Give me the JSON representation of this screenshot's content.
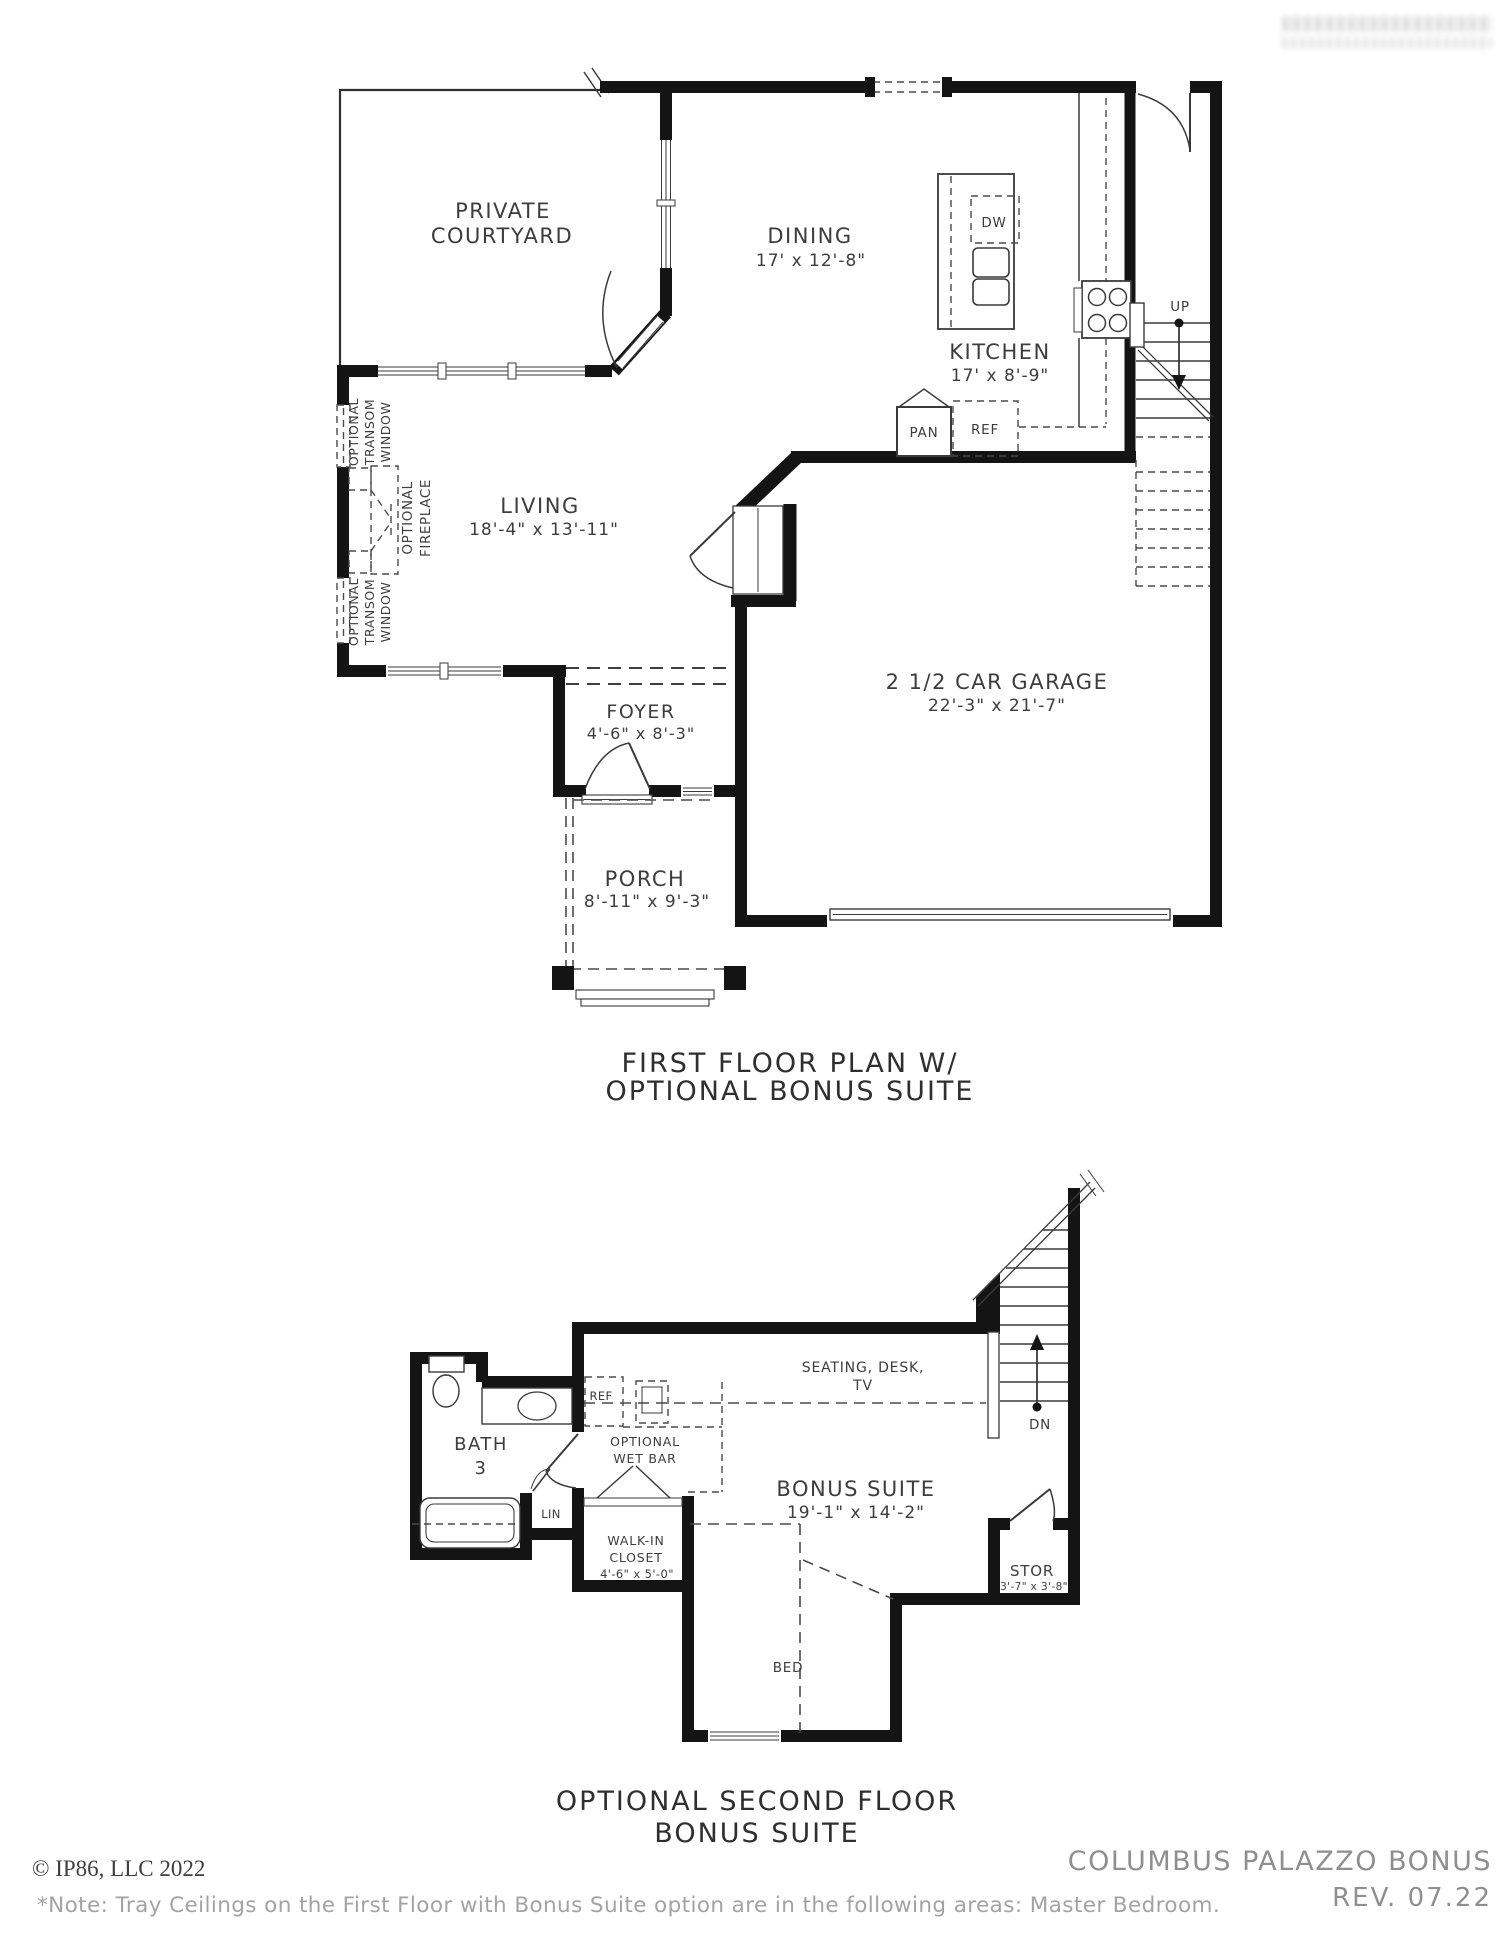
{
  "floor1": {
    "caption_line1": "FIRST FLOOR PLAN W/",
    "caption_line2": "OPTIONAL BONUS SUITE",
    "rooms": {
      "courtyard": {
        "name1": "PRIVATE",
        "name2": "COURTYARD"
      },
      "dining": {
        "name": "DINING",
        "dims": "17' x 12'-8\""
      },
      "kitchen": {
        "name": "KITCHEN",
        "dims": "17' x 8'-9\""
      },
      "living": {
        "name": "LIVING",
        "dims": "18'-4\" x 13'-11\""
      },
      "garage": {
        "name": "2 1/2 CAR GARAGE",
        "dims": "22'-3\" x 21'-7\""
      },
      "foyer": {
        "name": "FOYER",
        "dims": "4'-6\" x 8'-3\""
      },
      "porch": {
        "name": "PORCH",
        "dims": "8'-11\" x 9'-3\""
      }
    },
    "fixtures": {
      "dw": "DW",
      "pan": "PAN",
      "ref": "REF",
      "up": "UP"
    },
    "annotations": {
      "transom_top": [
        "OPTIONAL",
        "TRANSOM",
        "WINDOW"
      ],
      "transom_bottom": [
        "OPTIONAL",
        "TRANSOM",
        "WINDOW"
      ],
      "fireplace": [
        "OPTIONAL",
        "FIREPLACE"
      ]
    }
  },
  "floor2": {
    "caption_line1": "OPTIONAL SECOND FLOOR",
    "caption_line2": "BONUS SUITE",
    "rooms": {
      "bath": {
        "name": "BATH",
        "num": "3"
      },
      "bonus": {
        "name": "BONUS SUITE",
        "dims": "19'-1\" x 14'-2\""
      },
      "closet": {
        "name1": "WALK-IN",
        "name2": "CLOSET",
        "dims": "4'-6\" x 5'-0\""
      },
      "stor": {
        "name": "STOR",
        "dims": "3'-7\" x 3'-8\""
      },
      "wetbar": {
        "name1": "OPTIONAL",
        "name2": "WET BAR"
      },
      "seating": {
        "line1": "SEATING, DESK,",
        "line2": "TV"
      },
      "bed": "BED",
      "lin": "LIN",
      "ref": "REF",
      "dn": "DN"
    }
  },
  "footer": {
    "copyright": "© IP86, LLC 2022",
    "note": "*Note: Tray Ceilings on  the First Floor with Bonus Suite option are in the following areas: Master Bedroom.",
    "plan_name": "COLUMBUS PALAZZO BONUS",
    "revision": "REV. 07.22"
  }
}
